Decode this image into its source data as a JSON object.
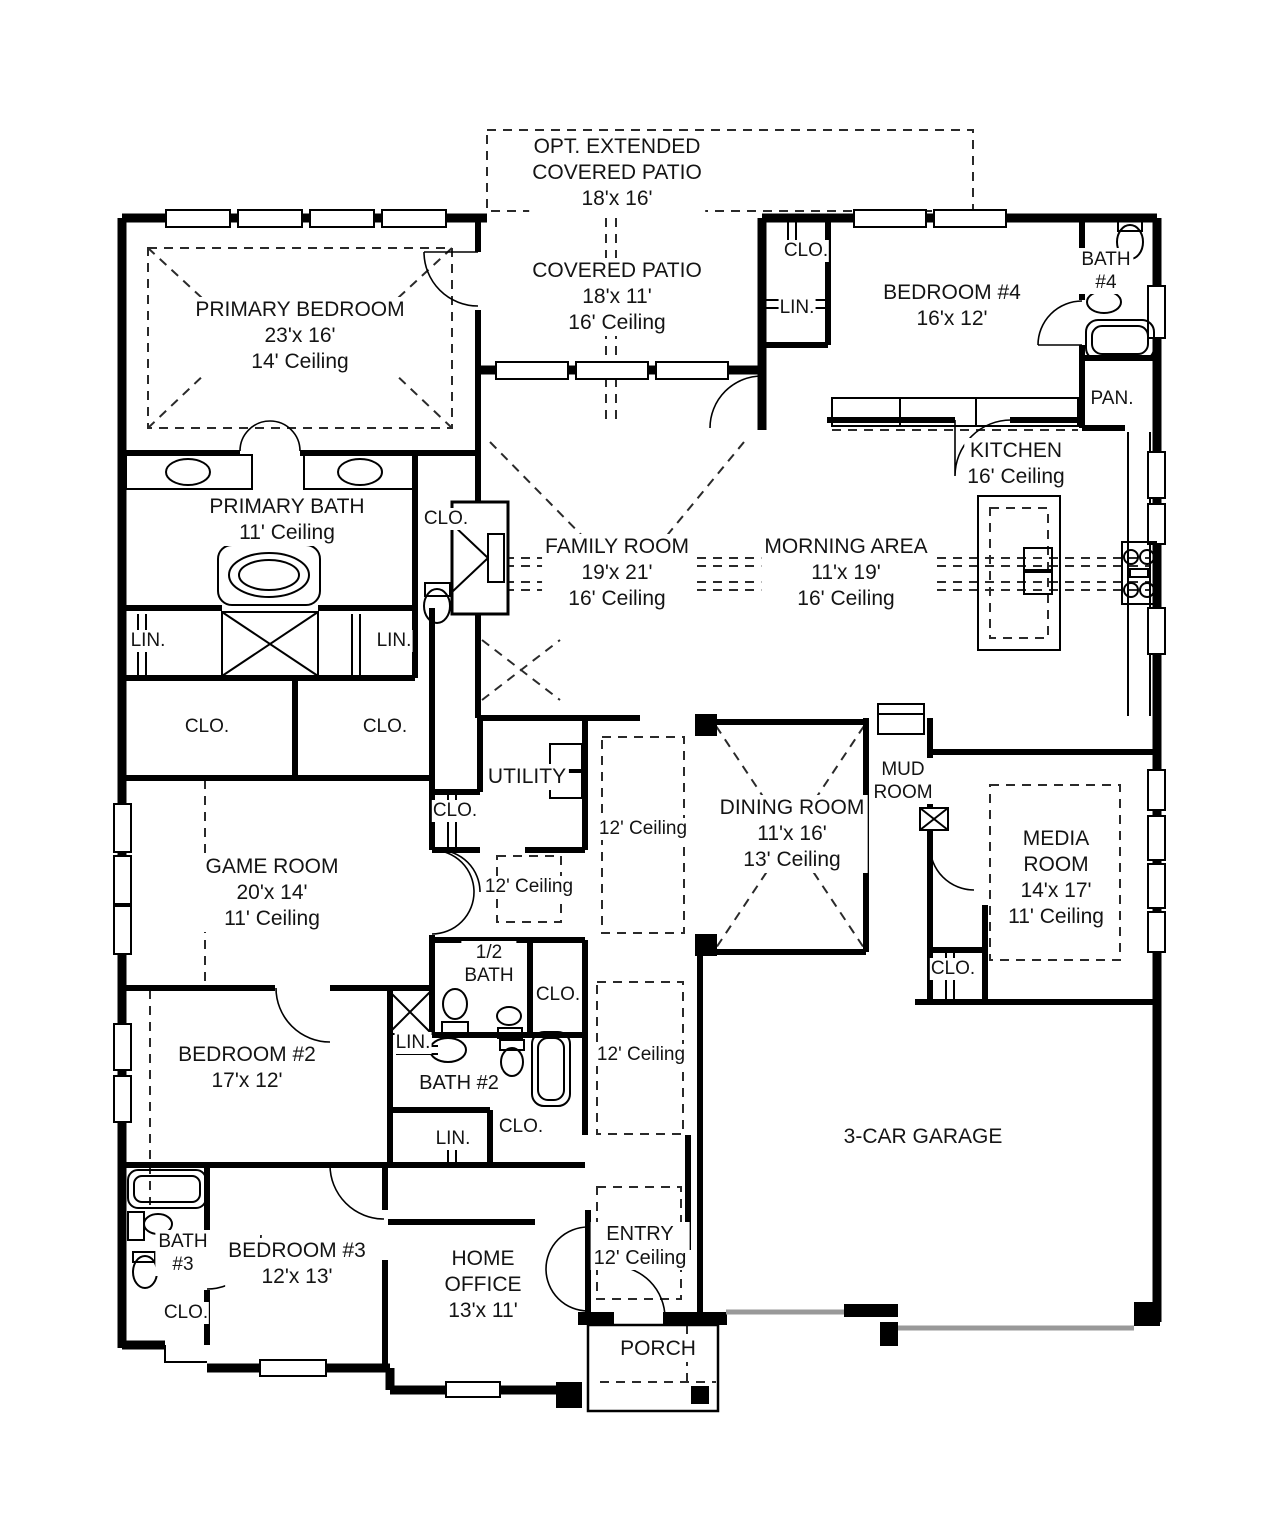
{
  "plan": {
    "colors": {
      "wall": "#000000",
      "background": "#ffffff",
      "garage_door": "#999999"
    },
    "rooms": {
      "opt_patio": {
        "line1": "OPT. EXTENDED",
        "line2": "COVERED PATIO",
        "dims": "18'x 16'"
      },
      "covered_patio": {
        "line1": "COVERED PATIO",
        "dims": "18'x 11'",
        "ceiling": "16' Ceiling"
      },
      "primary_bedroom": {
        "line1": "PRIMARY BEDROOM",
        "dims": "23'x 16'",
        "ceiling": "14' Ceiling"
      },
      "bedroom4": {
        "line1": "BEDROOM #4",
        "dims": "16'x 12'"
      },
      "bath4": {
        "line1": "BATH",
        "line2": "#4"
      },
      "pantry": {
        "line1": "PAN."
      },
      "kitchen": {
        "line1": "KITCHEN",
        "ceiling": "16' Ceiling"
      },
      "primary_bath": {
        "line1": "PRIMARY BATH",
        "ceiling": "11' Ceiling"
      },
      "family_room": {
        "line1": "FAMILY ROOM",
        "dims": "19'x 21'",
        "ceiling": "16' Ceiling"
      },
      "morning_area": {
        "line1": "MORNING AREA",
        "dims": "11'x 19'",
        "ceiling": "16' Ceiling"
      },
      "utility": {
        "line1": "UTILITY"
      },
      "dining_room": {
        "line1": "DINING ROOM",
        "dims": "11'x 16'",
        "ceiling": "13' Ceiling"
      },
      "mud_room": {
        "line1": "MUD",
        "line2": "ROOM"
      },
      "media_room": {
        "line1": "MEDIA",
        "line2": "ROOM",
        "dims": "14'x 17'",
        "ceiling": "11' Ceiling"
      },
      "game_room": {
        "line1": "GAME ROOM",
        "dims": "20'x 14'",
        "ceiling": "11' Ceiling"
      },
      "half_bath": {
        "line1": "1/2",
        "line2": "BATH"
      },
      "bedroom2": {
        "line1": "BEDROOM #2",
        "dims": "17'x 12'"
      },
      "bath2": {
        "line1": "BATH #2"
      },
      "bath3": {
        "line1": "BATH",
        "line2": "#3"
      },
      "bedroom3": {
        "line1": "BEDROOM #3",
        "dims": "12'x 13'"
      },
      "home_office": {
        "line1": "HOME",
        "line2": "OFFICE",
        "dims": "13'x 11'"
      },
      "entry": {
        "line1": "ENTRY",
        "ceiling": "12' Ceiling"
      },
      "porch": {
        "line1": "PORCH"
      },
      "garage": {
        "line1": "3-CAR GARAGE"
      }
    },
    "tags": {
      "clo": "CLO.",
      "lin": "LIN.",
      "ceiling12": "12' Ceiling"
    }
  }
}
